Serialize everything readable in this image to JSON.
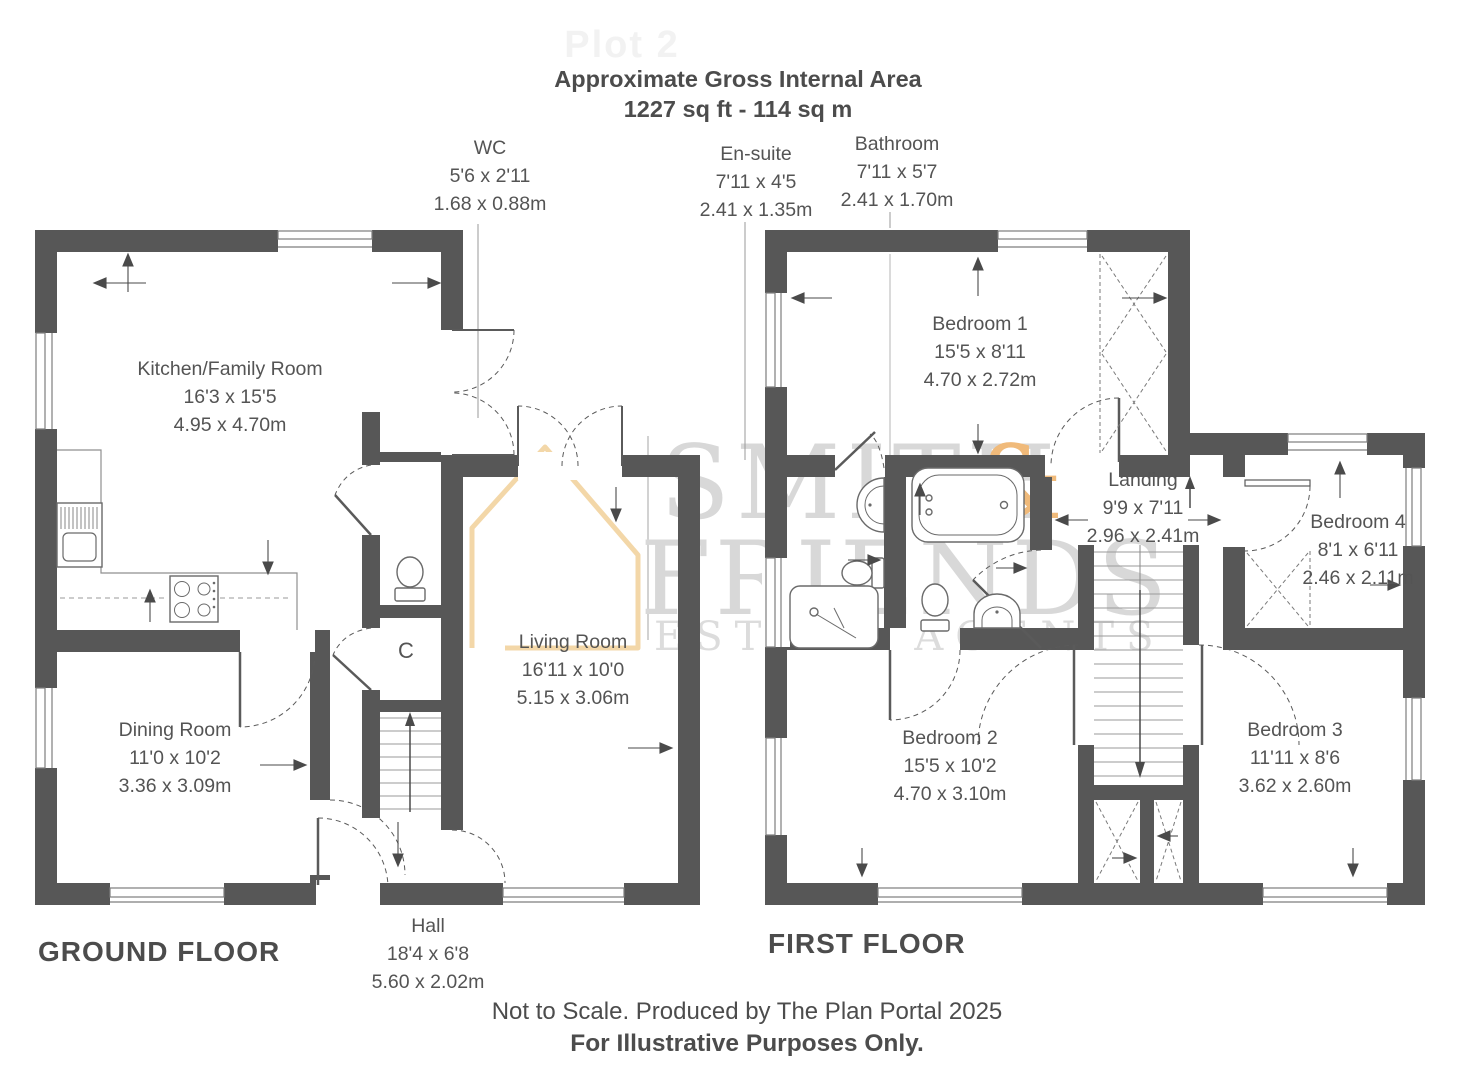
{
  "header": {
    "plot": "Plot 2",
    "title": "Approximate Gross Internal Area",
    "area": "1227 sq ft - 114 sq m"
  },
  "watermark": {
    "word1": "SMITH",
    "amp": "&",
    "word2": "FRIENDS",
    "tagline": "ESTATE AGENTS"
  },
  "ground_floor": {
    "title": "GROUND FLOOR",
    "rooms": {
      "wc": {
        "name": "WC",
        "imperial": "5'6 x 2'11",
        "metric": "1.68 x 0.88m"
      },
      "kitchen": {
        "name": "Kitchen/Family Room",
        "imperial": "16'3 x 15'5",
        "metric": "4.95 x 4.70m"
      },
      "dining": {
        "name": "Dining Room",
        "imperial": "11'0 x 10'2",
        "metric": "3.36 x 3.09m"
      },
      "living": {
        "name": "Living Room",
        "imperial": "16'11 x 10'0",
        "metric": "5.15 x 3.06m"
      },
      "hall": {
        "name": "Hall",
        "imperial": "18'4 x 6'8",
        "metric": "5.60 x 2.02m"
      },
      "cupboard": {
        "name": "C"
      }
    }
  },
  "first_floor": {
    "title": "FIRST FLOOR",
    "rooms": {
      "ensuite": {
        "name": "En-suite",
        "imperial": "7'11 x 4'5",
        "metric": "2.41 x 1.35m"
      },
      "bathroom": {
        "name": "Bathroom",
        "imperial": "7'11 x 5'7",
        "metric": "2.41 x 1.70m"
      },
      "bedroom1": {
        "name": "Bedroom 1",
        "imperial": "15'5 x 8'11",
        "metric": "4.70 x 2.72m"
      },
      "landing": {
        "name": "Landing",
        "imperial": "9'9 x 7'11",
        "metric": "2.96 x 2.41m"
      },
      "bedroom4": {
        "name": "Bedroom 4",
        "imperial": "8'1 x 6'11",
        "metric": "2.46 x 2.11m"
      },
      "bedroom2": {
        "name": "Bedroom 2",
        "imperial": "15'5 x 10'2",
        "metric": "4.70 x 3.10m"
      },
      "bedroom3": {
        "name": "Bedroom 3",
        "imperial": "11'11 x 8'6",
        "metric": "3.62 x 2.60m"
      }
    }
  },
  "footer": {
    "line1": "Not to Scale. Produced by The Plan Portal 2025",
    "line2": "For Illustrative Purposes Only."
  },
  "colors": {
    "wall": "#575757",
    "label_text": "#545454",
    "watermark_gray": "#d8d8d8",
    "watermark_orange": "#f0ba7a",
    "house_outline": "#f3d7a8"
  }
}
